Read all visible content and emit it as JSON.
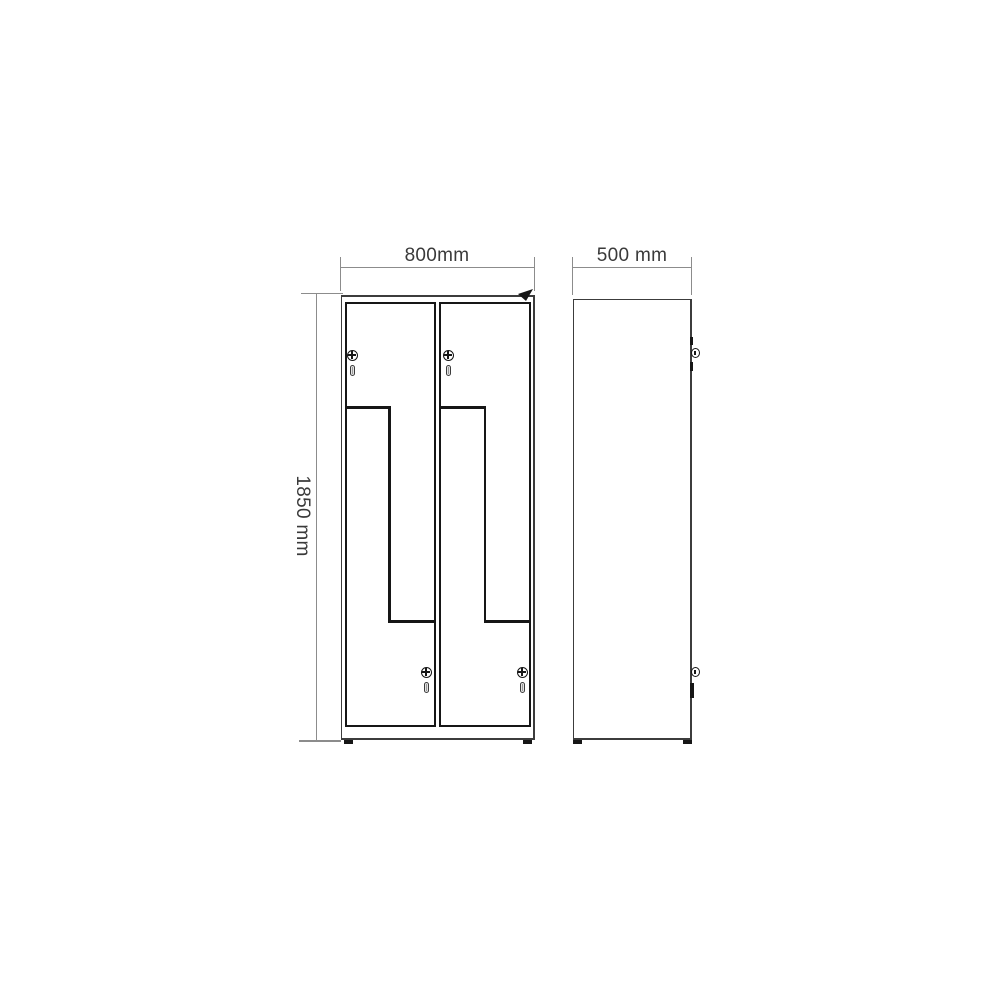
{
  "dimensions": {
    "width": "800mm",
    "depth": "500 mm",
    "height": "1850 mm"
  },
  "views": {
    "front": {
      "columns": 2,
      "doors_per_column": 2,
      "door_style": "Z-shaped interlocking doors",
      "locks_per_column": 2
    },
    "side": {
      "lock_details": 2
    }
  },
  "icons": {
    "cam_lock": "circle-with-cross",
    "door_handle": "vertical-slot",
    "corner_arrow": "north-east-arrowhead",
    "side_lock": "protruding-knob-with-ticks"
  },
  "colors": {
    "background": "#ffffff",
    "outline_dark": "#161616",
    "outline_medium": "#3c3c3c",
    "dimension_line": "#8c8c8c",
    "label_text": "#3a3a3a",
    "handle_fill": "#e2e2e2"
  }
}
